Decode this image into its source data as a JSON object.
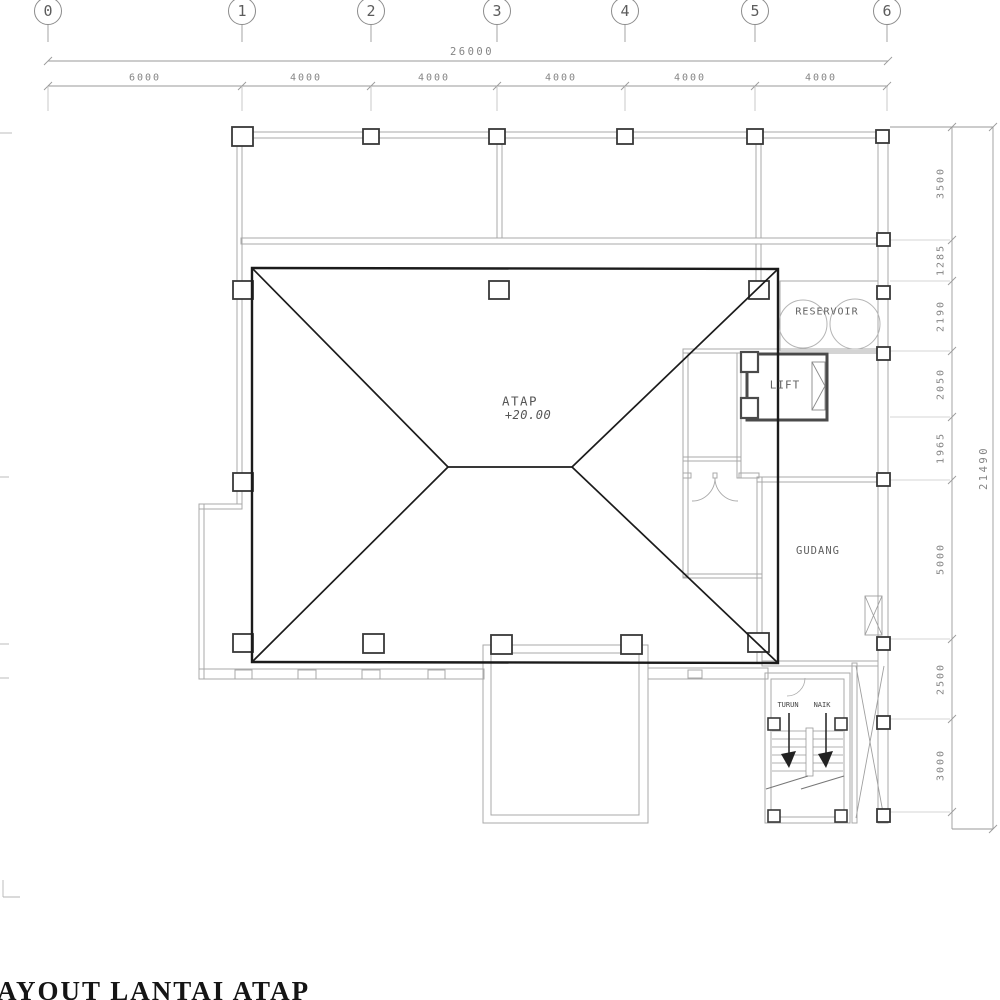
{
  "drawing_title": "AYOUT LANTAI ATAP",
  "grid": {
    "labels": [
      "0",
      "1",
      "2",
      "3",
      "4",
      "5",
      "6"
    ]
  },
  "dims": {
    "top": {
      "total": "26000",
      "segments": [
        "6000",
        "4000",
        "4000",
        "4000",
        "4000",
        "4000"
      ]
    },
    "right": {
      "total": "21490",
      "segments": [
        "3500",
        "1285",
        "2190",
        "2050",
        "1965",
        "5000",
        "2500",
        "3000"
      ]
    }
  },
  "labels": {
    "roof": "ATAP",
    "roof_level": "+20.00",
    "reservoir": "RESERVOIR",
    "lift": "LIFT",
    "gudang": "GUDANG",
    "stair_down": "TURUN",
    "stair_up": "NAIK"
  },
  "colors": {
    "roof_line": "#1b1b1b",
    "wall_line": "#a9a9a9",
    "dimension_line": "#9a9a9a",
    "column_line": "#383838"
  }
}
